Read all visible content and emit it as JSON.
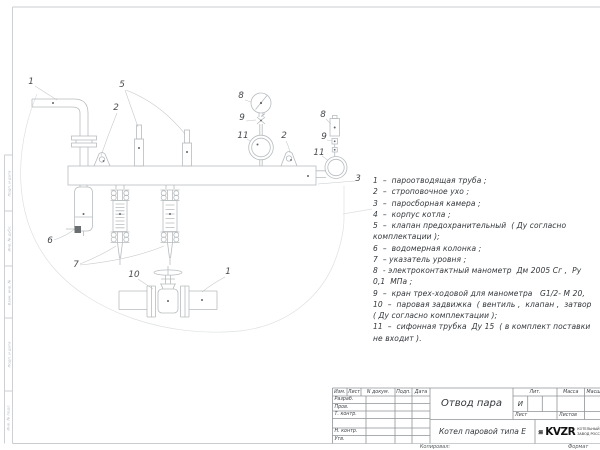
{
  "sheet": {
    "copied_label": "Копировал:",
    "format_label": "Формат"
  },
  "schematic": {
    "parts_list_lines": [
      "1  –  пароотводящая труба ;",
      "2  –  строповочное ухо ;",
      "3  –  паросборная камера ;",
      "4  –  корпус котла ;",
      "5  –  клапан предохранительный  ( Ду согласно",
      "комплектации );",
      "6  –  водомерная колонка ;",
      "7  – указатель уровня ;",
      "8  - электроконтактный манометр  Дм 2005 Сг ,  Ру",
      "0,1  МПа ;",
      "9  –  кран трех-ходовой для манометра   G1/2- М 20,",
      "10  –  паровая задвижка  ( вентиль ,  клапан ,  затвор",
      "( Ду согласно комплектации );",
      "11  –  сифонная трубка  Ду 15  ( в комплект поставки",
      "не входит )."
    ],
    "callouts": [
      {
        "n": "1",
        "x": 31,
        "y": 84
      },
      {
        "n": "5",
        "x": 122,
        "y": 87
      },
      {
        "n": "2",
        "x": 116,
        "y": 110
      },
      {
        "n": "8",
        "x": 241,
        "y": 98
      },
      {
        "n": "9",
        "x": 242,
        "y": 120
      },
      {
        "n": "11",
        "x": 243,
        "y": 138
      },
      {
        "n": "2",
        "x": 284,
        "y": 138
      },
      {
        "n": "8",
        "x": 323,
        "y": 117
      },
      {
        "n": "9",
        "x": 324,
        "y": 139
      },
      {
        "n": "11",
        "x": 319,
        "y": 155
      },
      {
        "n": "3",
        "x": 358,
        "y": 181
      },
      {
        "n": "6",
        "x": 50,
        "y": 243
      },
      {
        "n": "7",
        "x": 76,
        "y": 267
      },
      {
        "n": "10",
        "x": 134,
        "y": 277
      },
      {
        "n": "1",
        "x": 228,
        "y": 274
      }
    ]
  },
  "title_block": {
    "title": "Отвод пара",
    "subtitle": "Котел паровой типа Е",
    "cols": {
      "izm": "Изм.",
      "list": "Лист",
      "doc": "N докум.",
      "podp": "Подп.",
      "data": "Дата"
    },
    "rows": {
      "razrab": "Разраб.",
      "prov": "Пров.",
      "tkontr": "Т. контр.",
      "nkontr": "Н. контр.",
      "utv": "Утв."
    },
    "lit_label": "Лит.",
    "mass_label": "Масса",
    "scale_label": "Масштаб",
    "lit_value": "И",
    "sheet_label": "Лист",
    "sheets_label": "Листов",
    "logo_text": "KVZR",
    "logo_caption_1": "КОТЕЛЬНЫЙ",
    "logo_caption_2": "ЗАВОД РОССИИ"
  },
  "margin_labels": [
    "Подп. и дата",
    "Инв. № дубл.",
    "Взам. инв. №",
    "Подп. и дата",
    "Инв. № подл."
  ],
  "colors": {
    "line": "#b7bcbf",
    "faint": "#dde0e2",
    "leader": "#c6cacc",
    "frame": "#c9cdcf",
    "block_line": "#8f9497",
    "dot": "#606468"
  }
}
